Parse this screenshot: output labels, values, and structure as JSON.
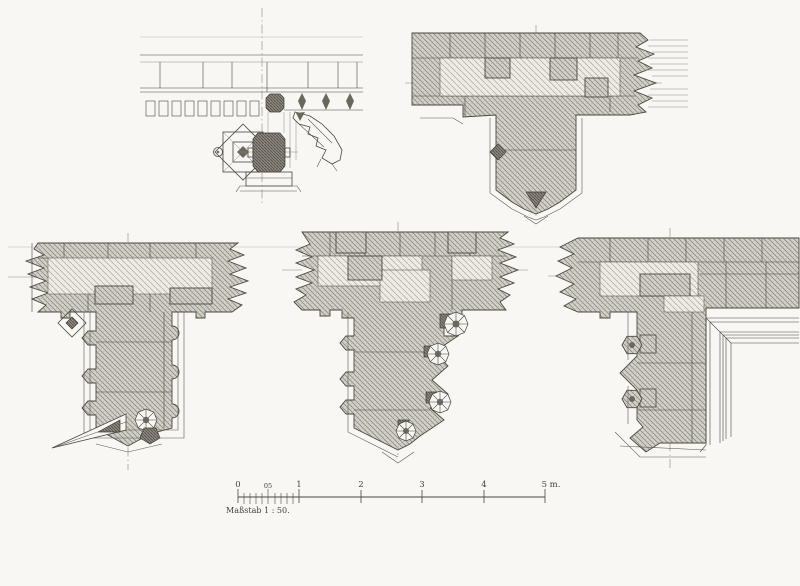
{
  "sheet": {
    "type": "architectural-plate",
    "palette": {
      "paper": "#f8f7f3",
      "ink": "#4b4740",
      "wall_hatch": "#d4d2ca",
      "wall_hatch_line": "#918d84",
      "light_hatch": "#edebe4",
      "light_hatch_line": "#b6b2a8",
      "dark_hatch": "#8e8a81",
      "dark_blob": "#6b675f"
    },
    "drawings": [
      {
        "name": "cornice-pinnacle-gargoyle-plan",
        "position": "top-left"
      },
      {
        "name": "buttress-plan-with-pier",
        "position": "top-right"
      },
      {
        "name": "buttress-plan-with-niches",
        "position": "middle-left"
      },
      {
        "name": "buttress-plan-with-rosettes",
        "position": "middle-center"
      },
      {
        "name": "buttress-corner-plan",
        "position": "middle-right"
      }
    ]
  },
  "scale_bar": {
    "caption": "Maßstab 1 : 50.",
    "ticks": [
      "0",
      "05",
      "1",
      "2",
      "3",
      "4",
      "5 m."
    ]
  }
}
